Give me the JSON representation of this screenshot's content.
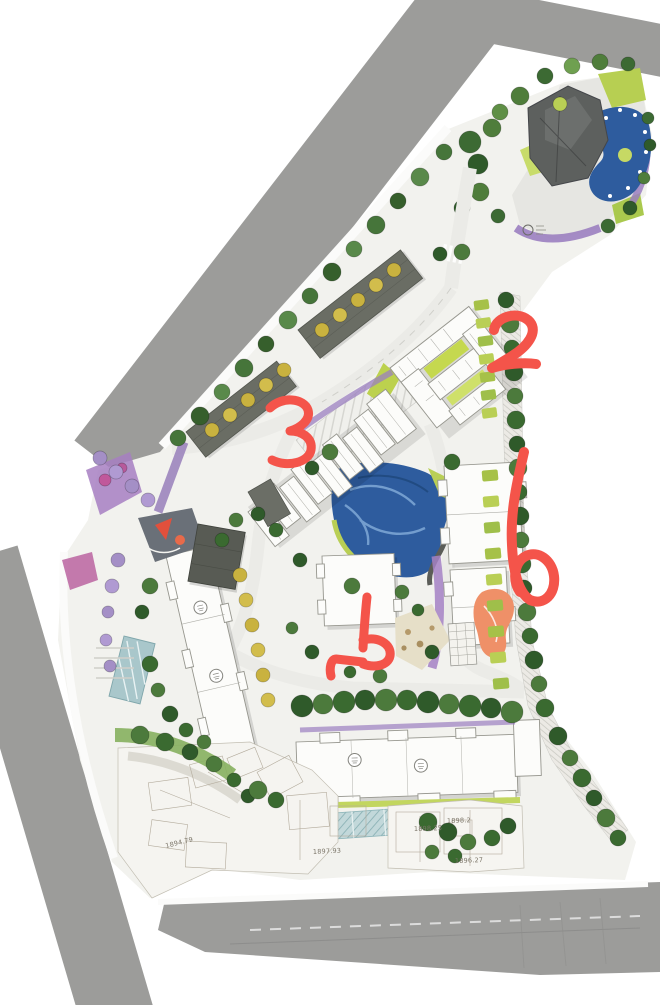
{
  "meta": {
    "type": "landscape-master-plan-rendering",
    "description": "Aerial colored site master plan of a residential development with hand-drawn red marker annotations",
    "canvas": {
      "width": 660,
      "height": 1005
    }
  },
  "palette": {
    "road": "#9c9c9a",
    "site_base": "#f2f2ee",
    "internal_road": "#ebebe7",
    "pond": "#2e5c9e",
    "pond_swirl": "#7fa8d6",
    "lawn": "#b9cf55",
    "lawn_light": "#cfe07a",
    "hedge": "#a6c148",
    "tree_dark": "#2f5a2a",
    "tree_mid": "#4f7d3b",
    "tree_light": "#6fa050",
    "tree_yellow": "#c9b23f",
    "tree_lavender": "#a48fc6",
    "planting_purple": "#9b7fc0",
    "planting_magenta": "#b75a9b",
    "building_dark": "#5d605e",
    "building_gray": "#6a6d64",
    "building_white": "#fcfcfa",
    "playground_orange": "#ef8f66",
    "play_red": "#e2503c",
    "glass_teal": "#bcd4d6",
    "annotation_red": "#f4544a"
  },
  "annotations": {
    "color": "#f4544a",
    "style": "hand-drawn red marker digits",
    "items": [
      {
        "id": "mark-2",
        "label": "2",
        "location": "east of school building"
      },
      {
        "id": "mark-3",
        "label": "3",
        "location": "west end of townhouse row"
      },
      {
        "id": "mark-5",
        "label": "5",
        "location": "central garden, rotated sideways"
      },
      {
        "id": "mark-6",
        "label": "6",
        "location": "outside east boundary"
      }
    ]
  },
  "elevations": {
    "items": [
      {
        "value": "1894.79"
      },
      {
        "value": "1897.93"
      },
      {
        "value": "1898.2"
      },
      {
        "value": "1898.25"
      },
      {
        "value": "1896.27"
      }
    ]
  },
  "badges": {
    "count": 4,
    "note": "small circular building-number stamps on white residential slabs, glyph illegible"
  }
}
